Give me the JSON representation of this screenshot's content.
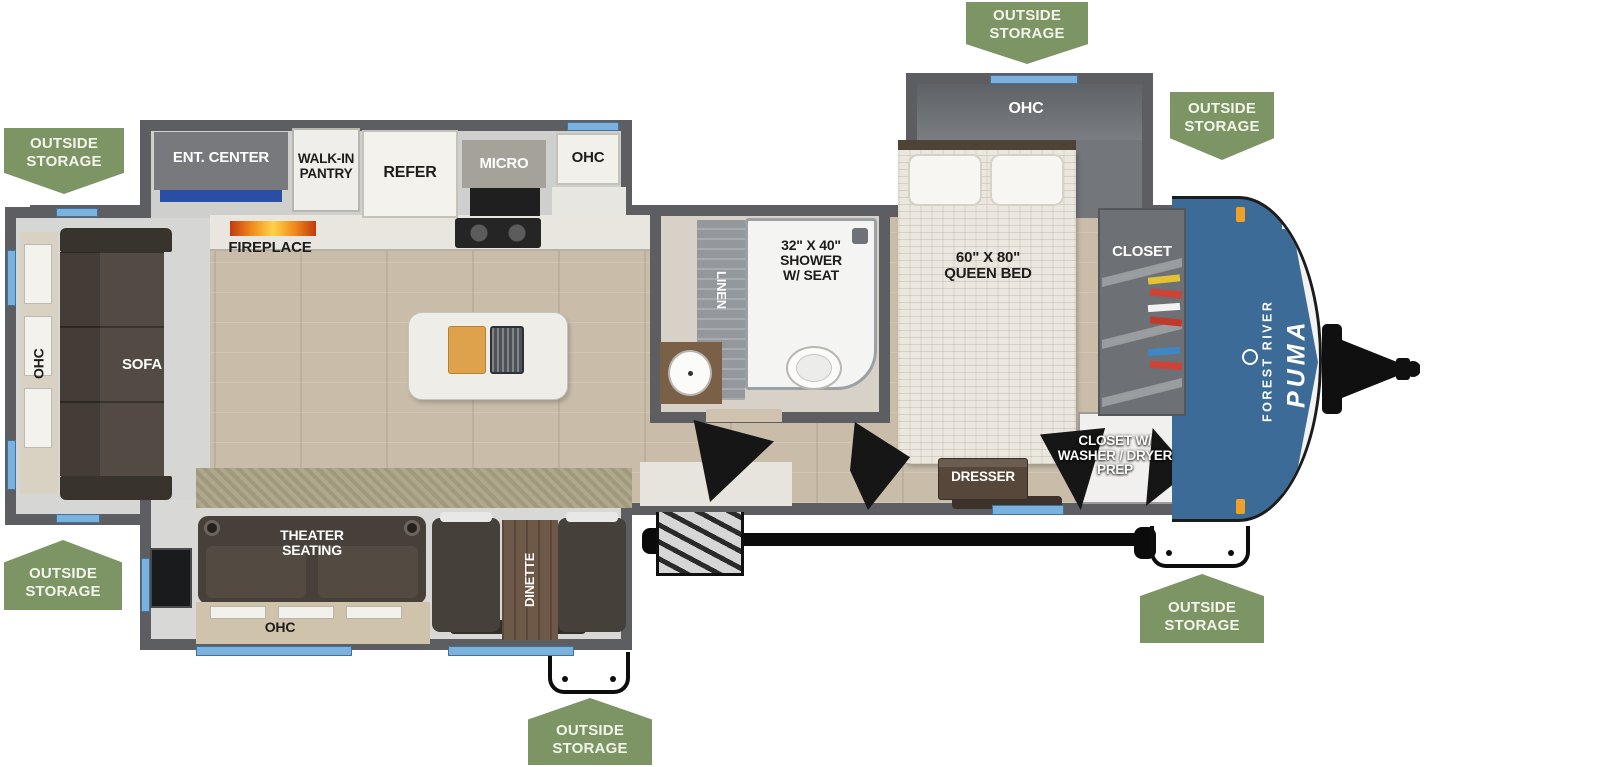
{
  "diagram_type": "rv-travel-trailer-floorplan",
  "brand": {
    "forest_river": "FOREST RIVER",
    "puma": "PUMA"
  },
  "badge_label": "OUTSIDE\nSTORAGE",
  "labels": {
    "ent_center": "ENT. CENTER",
    "walk_in_pantry": "WALK-IN\nPANTRY",
    "refer": "REFER",
    "micro": "MICRO",
    "ohc": "OHC",
    "fireplace": "FIREPLACE",
    "sofa": "SOFA",
    "linen": "LINEN",
    "shower": "32\" X 40\"\nSHOWER\nW/ SEAT",
    "queen_bed": "60\" X 80\"\nQUEEN BED",
    "closet": "CLOSET",
    "closet_washer_dryer": "CLOSET W/\nWASHER / DRYER\nPREP",
    "dresser": "DRESSER",
    "theater_seating": "THEATER\nSEATING",
    "dinette": "DINETTE"
  },
  "colors": {
    "badge_green": "#7D9464",
    "wall_gray": "#5C5E61",
    "window_blue": "#7AB1DD",
    "cap_blue": "#3D6B98",
    "flame_orange": "#F08A1A",
    "floor_tan": "#C9BDAA"
  }
}
